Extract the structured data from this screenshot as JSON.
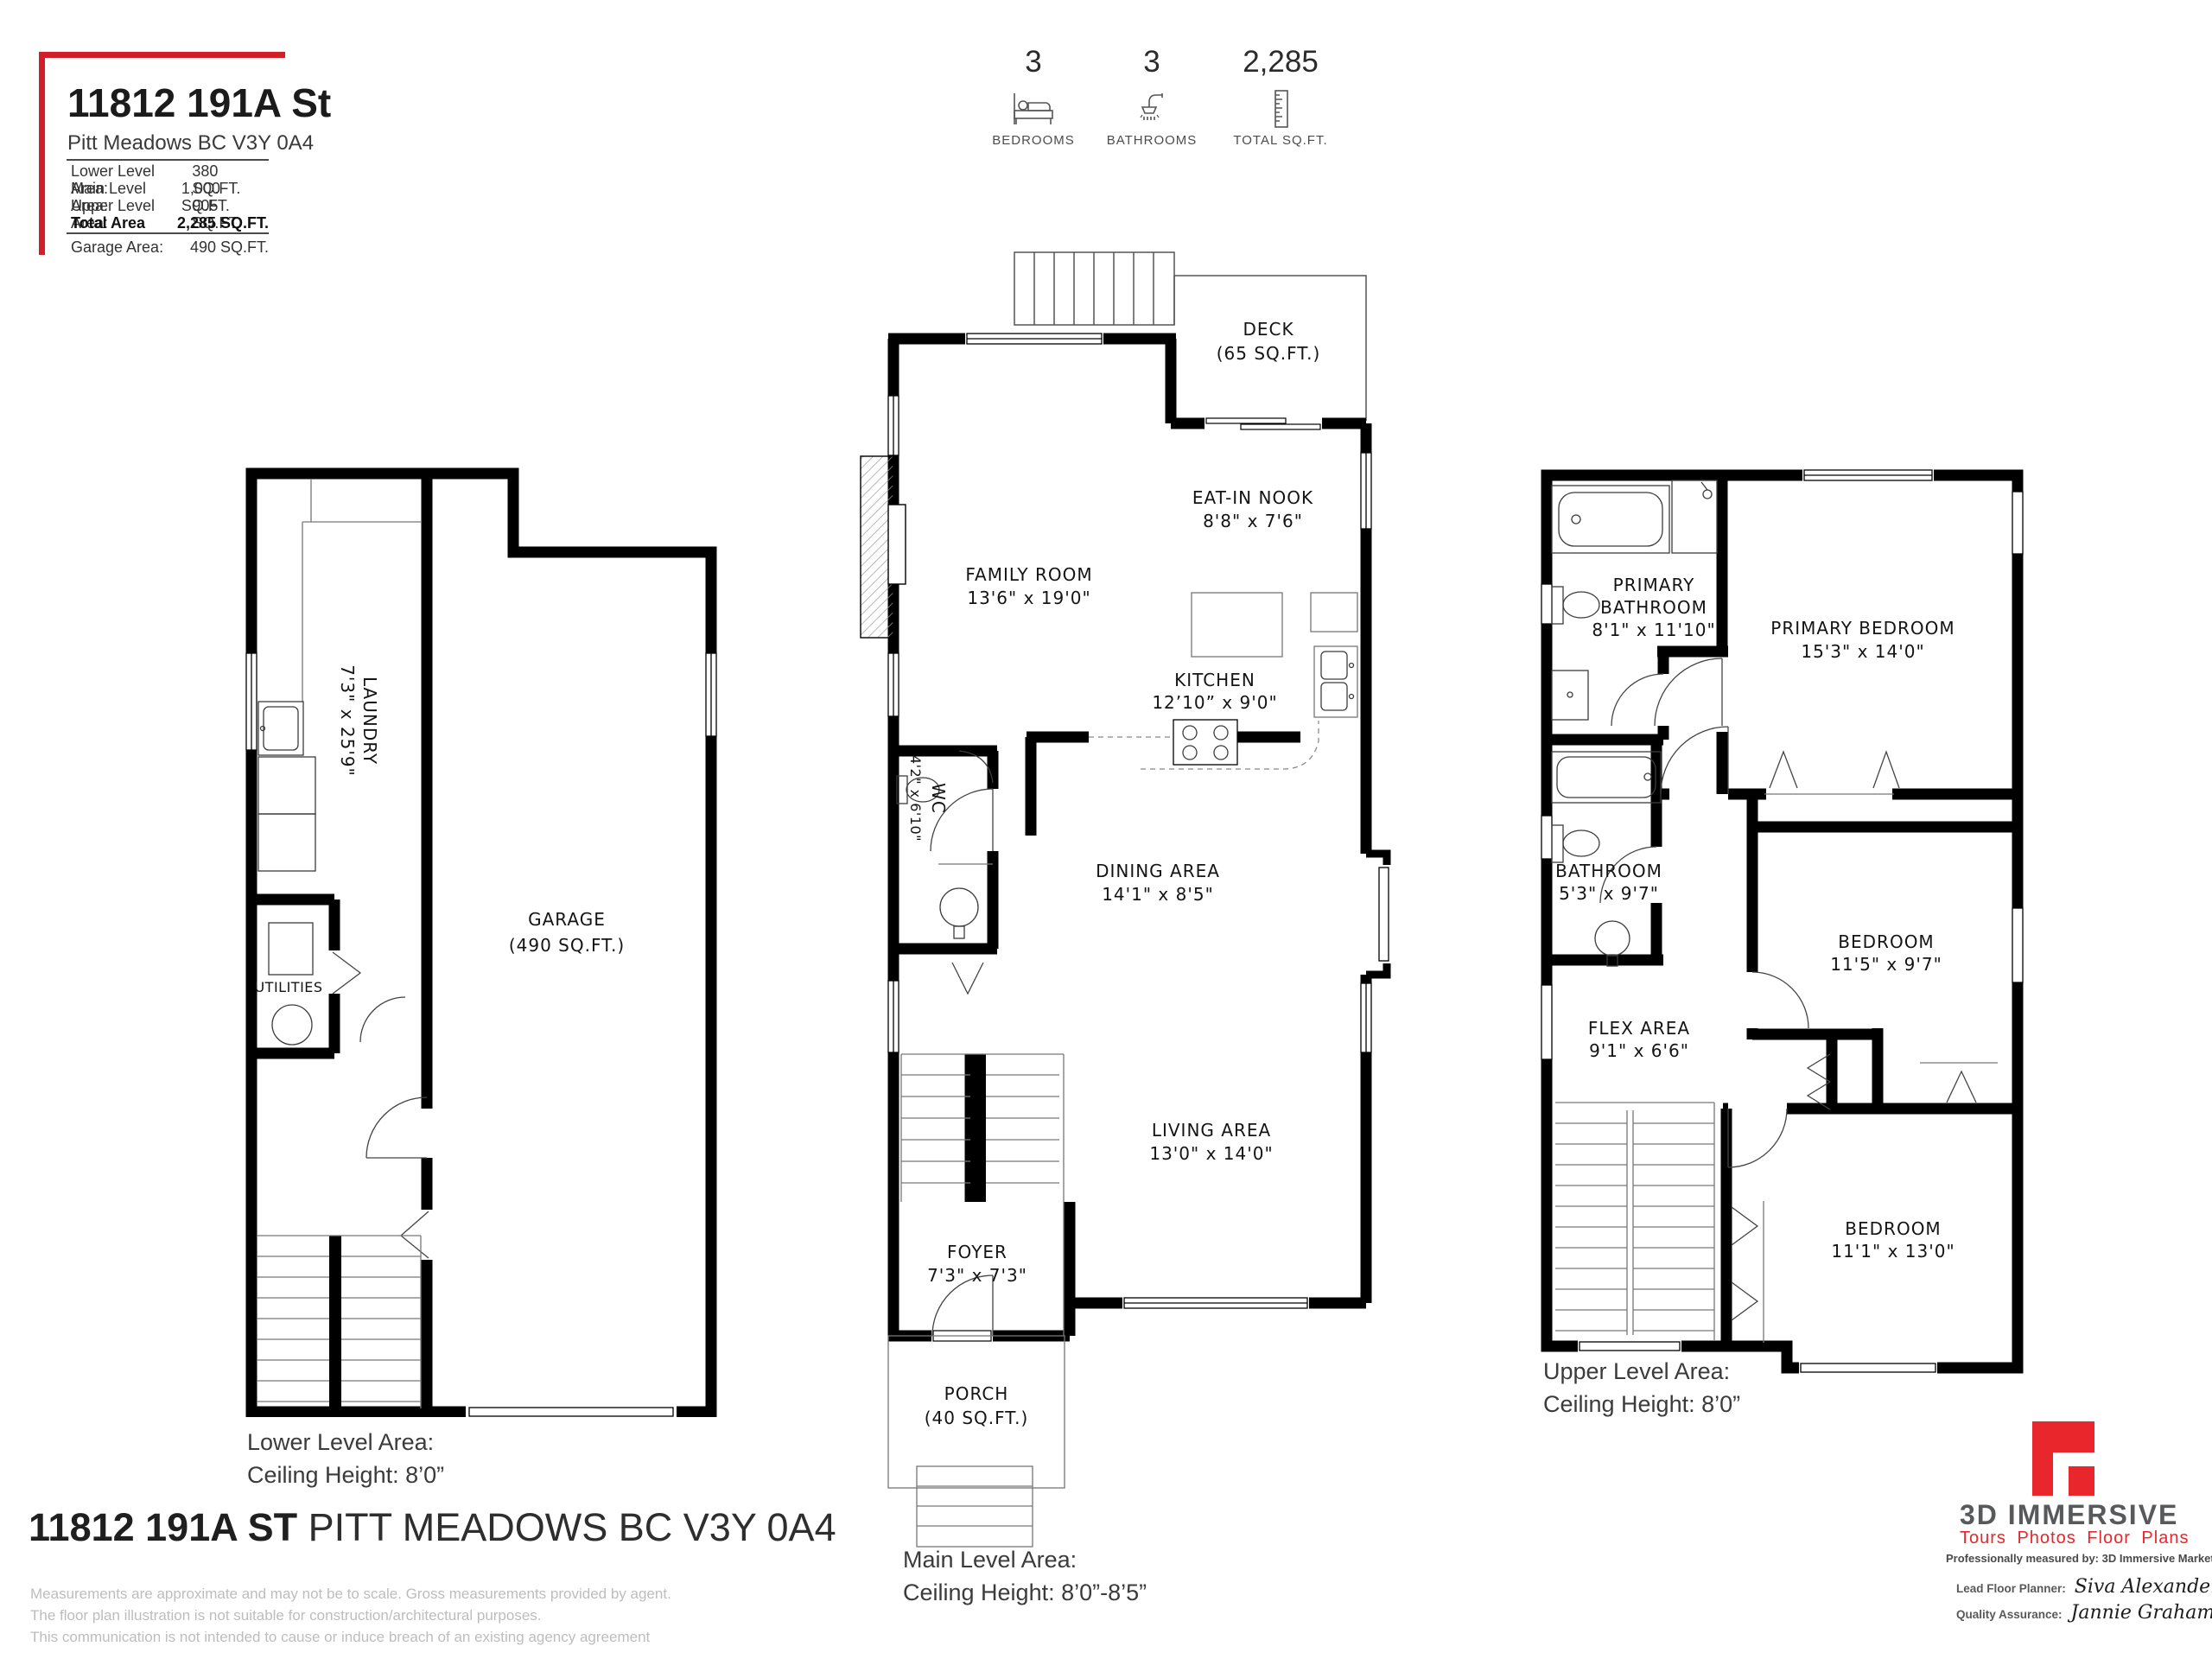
{
  "header": {
    "title": "11812 191A St",
    "subtitle": "Pitt Meadows BC V3Y 0A4",
    "area_rows": [
      {
        "label": "Lower Level Area:",
        "value": "380 SQ.FT."
      },
      {
        "label": "Main Level Area:",
        "value": "1,000 SQ.FT."
      },
      {
        "label": "Upper Level Area:",
        "value": "905 SQ.FT."
      },
      {
        "label": "Total Area",
        "value": "2,285 SQ.FT."
      },
      {
        "label": "Garage Area:",
        "value": "490 SQ.FT."
      }
    ]
  },
  "stats": {
    "bedrooms": {
      "value": "3",
      "label": "BEDROOMS"
    },
    "bathrooms": {
      "value": "3",
      "label": "BATHROOMS"
    },
    "total_sqft": {
      "value": "2,285",
      "label": "TOTAL SQ.FT."
    }
  },
  "lower": {
    "caption1": "Lower Level Area:",
    "caption2": "Ceiling Height: 8’0”",
    "rooms": {
      "laundry": {
        "name": "LAUNDRY",
        "dims": "7'3\" x 25'9\""
      },
      "utilities": {
        "name": "UTILITIES"
      },
      "garage": {
        "name": "GARAGE",
        "dims": "(490 SQ.FT.)"
      }
    }
  },
  "main": {
    "caption1": "Main Level Area:",
    "caption2": "Ceiling Height: 8’0”-8’5”",
    "rooms": {
      "deck": {
        "name": "DECK",
        "dims": "(65 SQ.FT.)"
      },
      "eat_in_nook": {
        "name": "EAT-IN NOOK",
        "dims": "8'8\" x 7'6\""
      },
      "family_room": {
        "name": "FAMILY ROOM",
        "dims": "13'6\" x 19'0\""
      },
      "kitchen": {
        "name": "KITCHEN",
        "dims": "12’10” x 9'0\""
      },
      "wc": {
        "name": "WC",
        "dims": "4'2\" x 6'10\""
      },
      "dining": {
        "name": "DINING AREA",
        "dims": "14'1\" x 8'5\""
      },
      "living": {
        "name": "LIVING AREA",
        "dims": "13'0\" x 14'0\""
      },
      "foyer": {
        "name": "FOYER",
        "dims": "7'3\" x 7'3\""
      },
      "porch": {
        "name": "PORCH",
        "dims": "(40 SQ.FT.)"
      }
    }
  },
  "upper": {
    "caption1": "Upper Level Area:",
    "caption2": "Ceiling Height: 8’0”",
    "rooms": {
      "primary_bathroom": {
        "name1": "PRIMARY",
        "name2": "BATHROOM",
        "dims": "8'1\" x 11'10\""
      },
      "primary_bedroom": {
        "name": "PRIMARY BEDROOM",
        "dims": "15'3\" x 14'0\""
      },
      "bathroom": {
        "name": "BATHROOM",
        "dims": "5'3\" x 9'7\""
      },
      "flex": {
        "name": "FLEX AREA",
        "dims": "9'1\" x 6'6\""
      },
      "bedroom1": {
        "name": "BEDROOM",
        "dims": "11'5\" x 9'7\""
      },
      "bedroom2": {
        "name": "BEDROOM",
        "dims": "11'1\" x 13'0\""
      }
    }
  },
  "footer": {
    "address_bold": "11812 191A ST",
    "address_rest": " PITT MEADOWS BC V3Y 0A4",
    "disclaimer1": "Measurements are approximate and may not be to scale. Gross measurements provided by agent.",
    "disclaimer2": "The floor plan illustration is not suitable for construction/architectural purposes.",
    "disclaimer3": "This communication is not intended to cause or induce breach of an existing agency agreement"
  },
  "branding": {
    "name": "3D IMMERSIVE",
    "tagline": "Tours  Photos  Floor Plans",
    "measured_by": "Professionally measured by: 3D Immersive Marketing Ltd.",
    "lead_label": "Lead Floor Planner:",
    "lead_name": "Siva Alexander",
    "qa_label": "Quality Assurance:",
    "qa_name": "Jannie Graham"
  },
  "colors": {
    "accent_red": "#d01f26",
    "logo_red": "#e8262c",
    "logo_gray": "#58595b"
  }
}
